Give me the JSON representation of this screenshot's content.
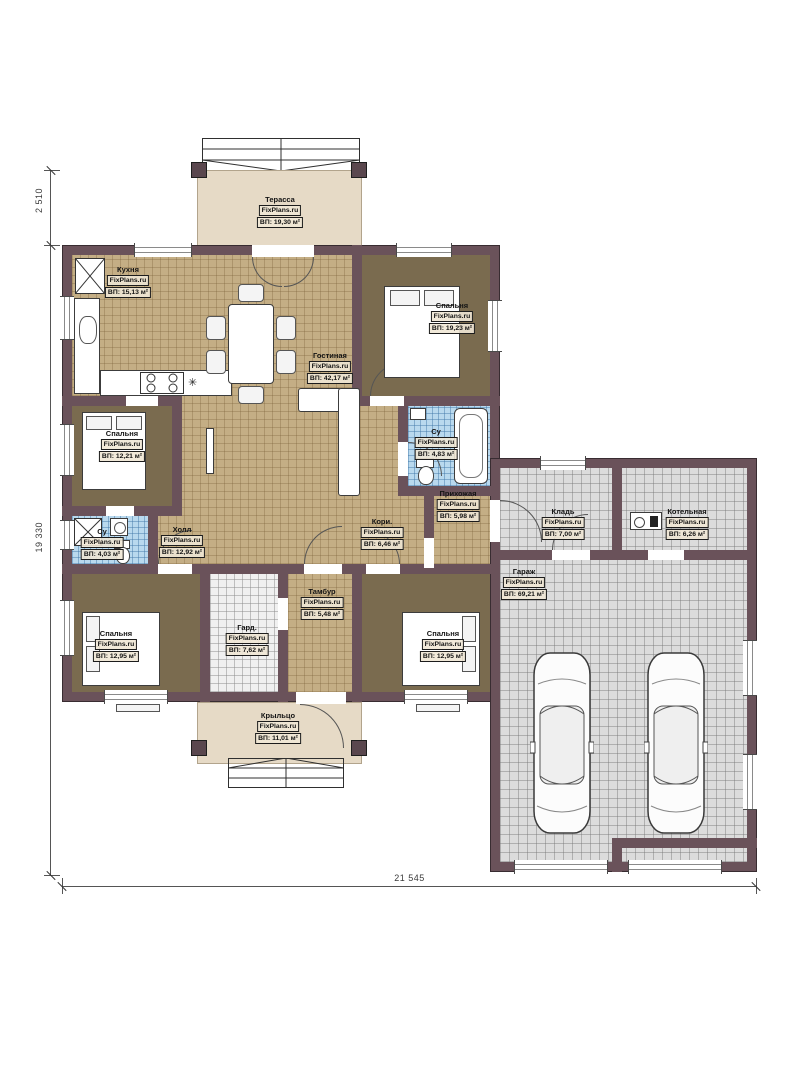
{
  "watermark": "FixPlans.ru",
  "rooms": [
    {
      "name": "Терасса",
      "area": "ВП: 19,30 м²"
    },
    {
      "name": "Кухня",
      "area": "ВП: 15,13 м²"
    },
    {
      "name": "Спальня",
      "area": "ВП: 19,23 м²"
    },
    {
      "name": "Гостиная",
      "area": "ВП: 42,17 м²"
    },
    {
      "name": "Спальня",
      "area": "ВП: 12,21 м²"
    },
    {
      "name": "Су",
      "area": "ВП: 4,83 м²"
    },
    {
      "name": "Прихожая",
      "area": "ВП: 5,98 м²"
    },
    {
      "name": "Кладь",
      "area": "ВП: 7,00 м²"
    },
    {
      "name": "Котельная",
      "area": "ВП: 6,26 м²"
    },
    {
      "name": "Су",
      "area": "ВП: 4,03 м²"
    },
    {
      "name": "Холл",
      "area": "ВП: 12,92 м²"
    },
    {
      "name": "Кори.",
      "area": "ВП: 6,46 м²"
    },
    {
      "name": "Гараж",
      "area": "ВП: 69,21 м²"
    },
    {
      "name": "Тамбур",
      "area": "ВП: 5,48 м²"
    },
    {
      "name": "Гард.",
      "area": "ВП: 7,62 м²"
    },
    {
      "name": "Спальня",
      "area": "ВП: 12,95 м²"
    },
    {
      "name": "Спальня",
      "area": "ВП: 12,95 м²"
    },
    {
      "name": "Крыльцо",
      "area": "ВП: 11,01 м²"
    }
  ],
  "dimensions": {
    "left_terrace": "2 510",
    "left_total": "19 330",
    "bottom_total": "21 545"
  },
  "icons": {
    "cooktop_star": "✳"
  },
  "colors": {
    "wall": "#6a525a",
    "floor_tile": "#c4ae85",
    "bedroom_floor": "#7a6b4f",
    "terrace": "#e6dac6",
    "garage_tile": "#dcdcdc",
    "bath_tile": "#b9d9ee"
  }
}
